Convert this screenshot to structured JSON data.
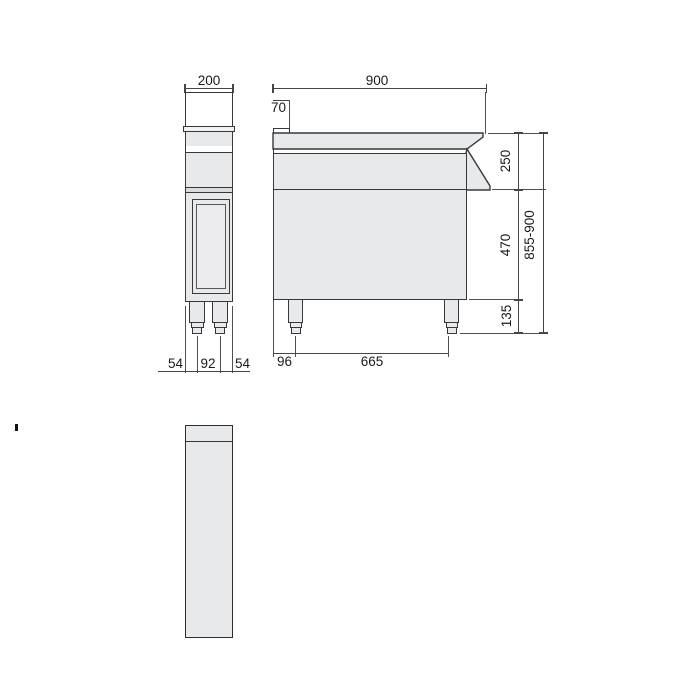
{
  "drawing": {
    "type": "technical-dimension-drawing",
    "colors": {
      "fill_gray": "#e8e9ea",
      "outline": "#38383a",
      "dimension_line": "#454547",
      "text": "#1b1b1d"
    },
    "dims": {
      "front_width": "200",
      "front_left_foot": "54",
      "front_foot_span": "92",
      "front_right_foot": "54",
      "depth": "900",
      "back_lip_depth": "70",
      "upper_section_height": "250",
      "body_section_height": "470",
      "leg_section_height": "135",
      "overall_height": "855-900",
      "leg_back_offset": "96",
      "leg_spacing": "665"
    }
  }
}
